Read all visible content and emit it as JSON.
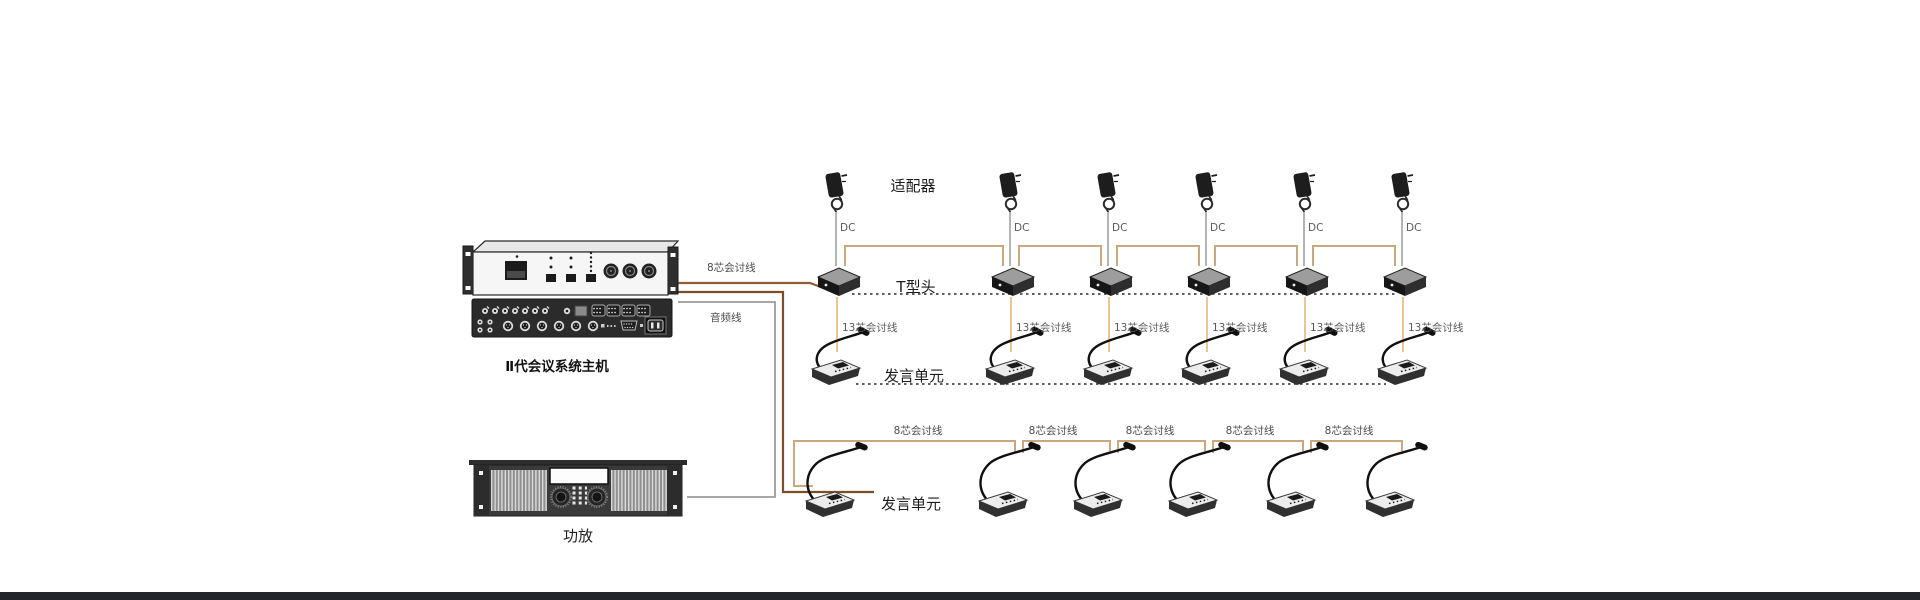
{
  "diagram_title": "conference-system-wiring-diagram",
  "labels": {
    "host": "Ⅱ代会议系统主机",
    "amplifier": "功放",
    "adapter_row": "适配器",
    "thead_row": "T型头",
    "mic_row_mid": "发言单元",
    "mic_row_bottom": "发言单元",
    "cable_8core_host": "8芯会讨线",
    "cable_audio": "音频线",
    "cable_dc": "DC",
    "cable_13core": "13芯会讨线",
    "cable_8core": "8芯会讨线"
  },
  "counts": {
    "adapters": 6,
    "t_heads": 6,
    "mid_row_units": 6,
    "bottom_row_units": 6,
    "bottom_row_cable_labels": 5
  },
  "colors": {
    "cable_brown_dark": "#7d4e26",
    "cable_brown": "#8e5e36",
    "cable_tan": "#c9a87e",
    "cable_orange": "#e9c795",
    "cable_gray": "#9b9b9b",
    "dotted": "#2a2a2a",
    "footer_bar": "#23262b"
  }
}
